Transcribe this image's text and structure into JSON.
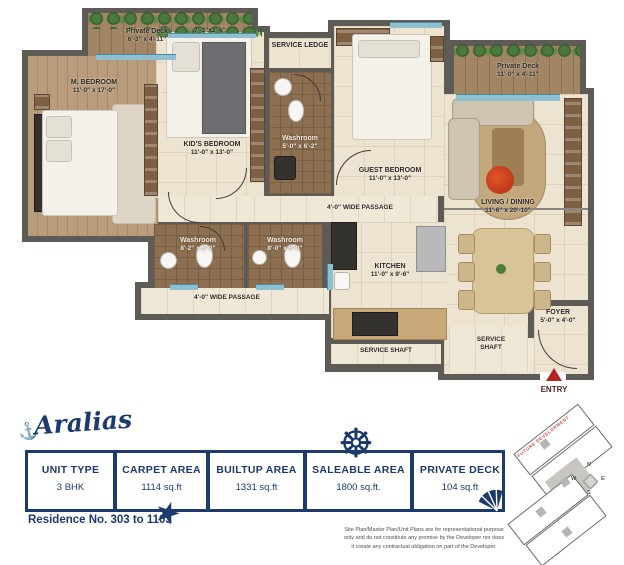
{
  "plan": {
    "rooms": {
      "deck_left": {
        "name": "Private Deck",
        "dims": "6'-3\" x 4'-11\""
      },
      "balcony": {
        "dims": "7'-3\"x2'-6\""
      },
      "m_bedroom": {
        "name": "M. BEDROOM",
        "dims": "11'-0\" x 17'-0\""
      },
      "kids_bedroom": {
        "name": "KID'S BEDROOM",
        "dims": "11'-0\" x 13'-0\""
      },
      "service_ledge": {
        "name": "SERVICE LEDGE"
      },
      "washroom_mid": {
        "name": "Washroom",
        "dims": "5'-0\" x 6'-2\""
      },
      "guest_bedroom": {
        "name": "GUEST BEDROOM",
        "dims": "11'-0\" x 13'-0\""
      },
      "deck_right": {
        "name": "Private Deck",
        "dims": "11'-0\" x 4'-11\""
      },
      "living_dining": {
        "name": "LIVING / DINING",
        "dims": "11'-6\" x 20'-10\""
      },
      "passage_upper": {
        "name": "4'-0\" WIDE PASSAGE"
      },
      "washroom_left": {
        "name": "Washroom",
        "dims": "8'-2\" x 5'-0\""
      },
      "washroom_right": {
        "name": "Washroom",
        "dims": "8'-0\" x 5'-0\""
      },
      "passage_lower": {
        "name": "4'-0\" WIDE PASSAGE"
      },
      "kitchen": {
        "name": "KITCHEN",
        "dims": "11'-0\" x 9'-6\""
      },
      "service_shaft_1": {
        "name": "SERVICE SHAFT"
      },
      "service_shaft_2": {
        "name": "SERVICE SHAFT"
      },
      "foyer": {
        "name": "FOYER",
        "dims": "5'-0\" x 4'-0\""
      },
      "entry": {
        "name": "ENTRY"
      }
    }
  },
  "footer": {
    "logo": "Aralias",
    "residence": "Residence No. 303 to 1103",
    "disclaimer": "Site Plan/Master Plan/Unit Plans are for representational purpose only and do not constitute any promise by the Developer nor does it create any contractual obligation on part of the Developer.",
    "spec_table": {
      "columns": [
        {
          "header": "UNIT TYPE",
          "value": "3 BHK"
        },
        {
          "header": "CARPET AREA",
          "value": "1114 sq.ft"
        },
        {
          "header": "BUILTUP AREA",
          "value": "1331 sq.ft"
        },
        {
          "header": "SALEABLE AREA",
          "value": "1800 sq.ft."
        },
        {
          "header": "PRIVATE DECK",
          "value": "104 sq.ft"
        }
      ]
    },
    "keyplan": {
      "future": "FUTURE DEVELOPMENT",
      "compass": {
        "n": "N",
        "e": "E",
        "s": "S",
        "w": "W"
      }
    },
    "colors": {
      "navy": "#1c3a6c",
      "wall_gray": "#5e5a56",
      "entry_red": "#b3251f"
    }
  }
}
